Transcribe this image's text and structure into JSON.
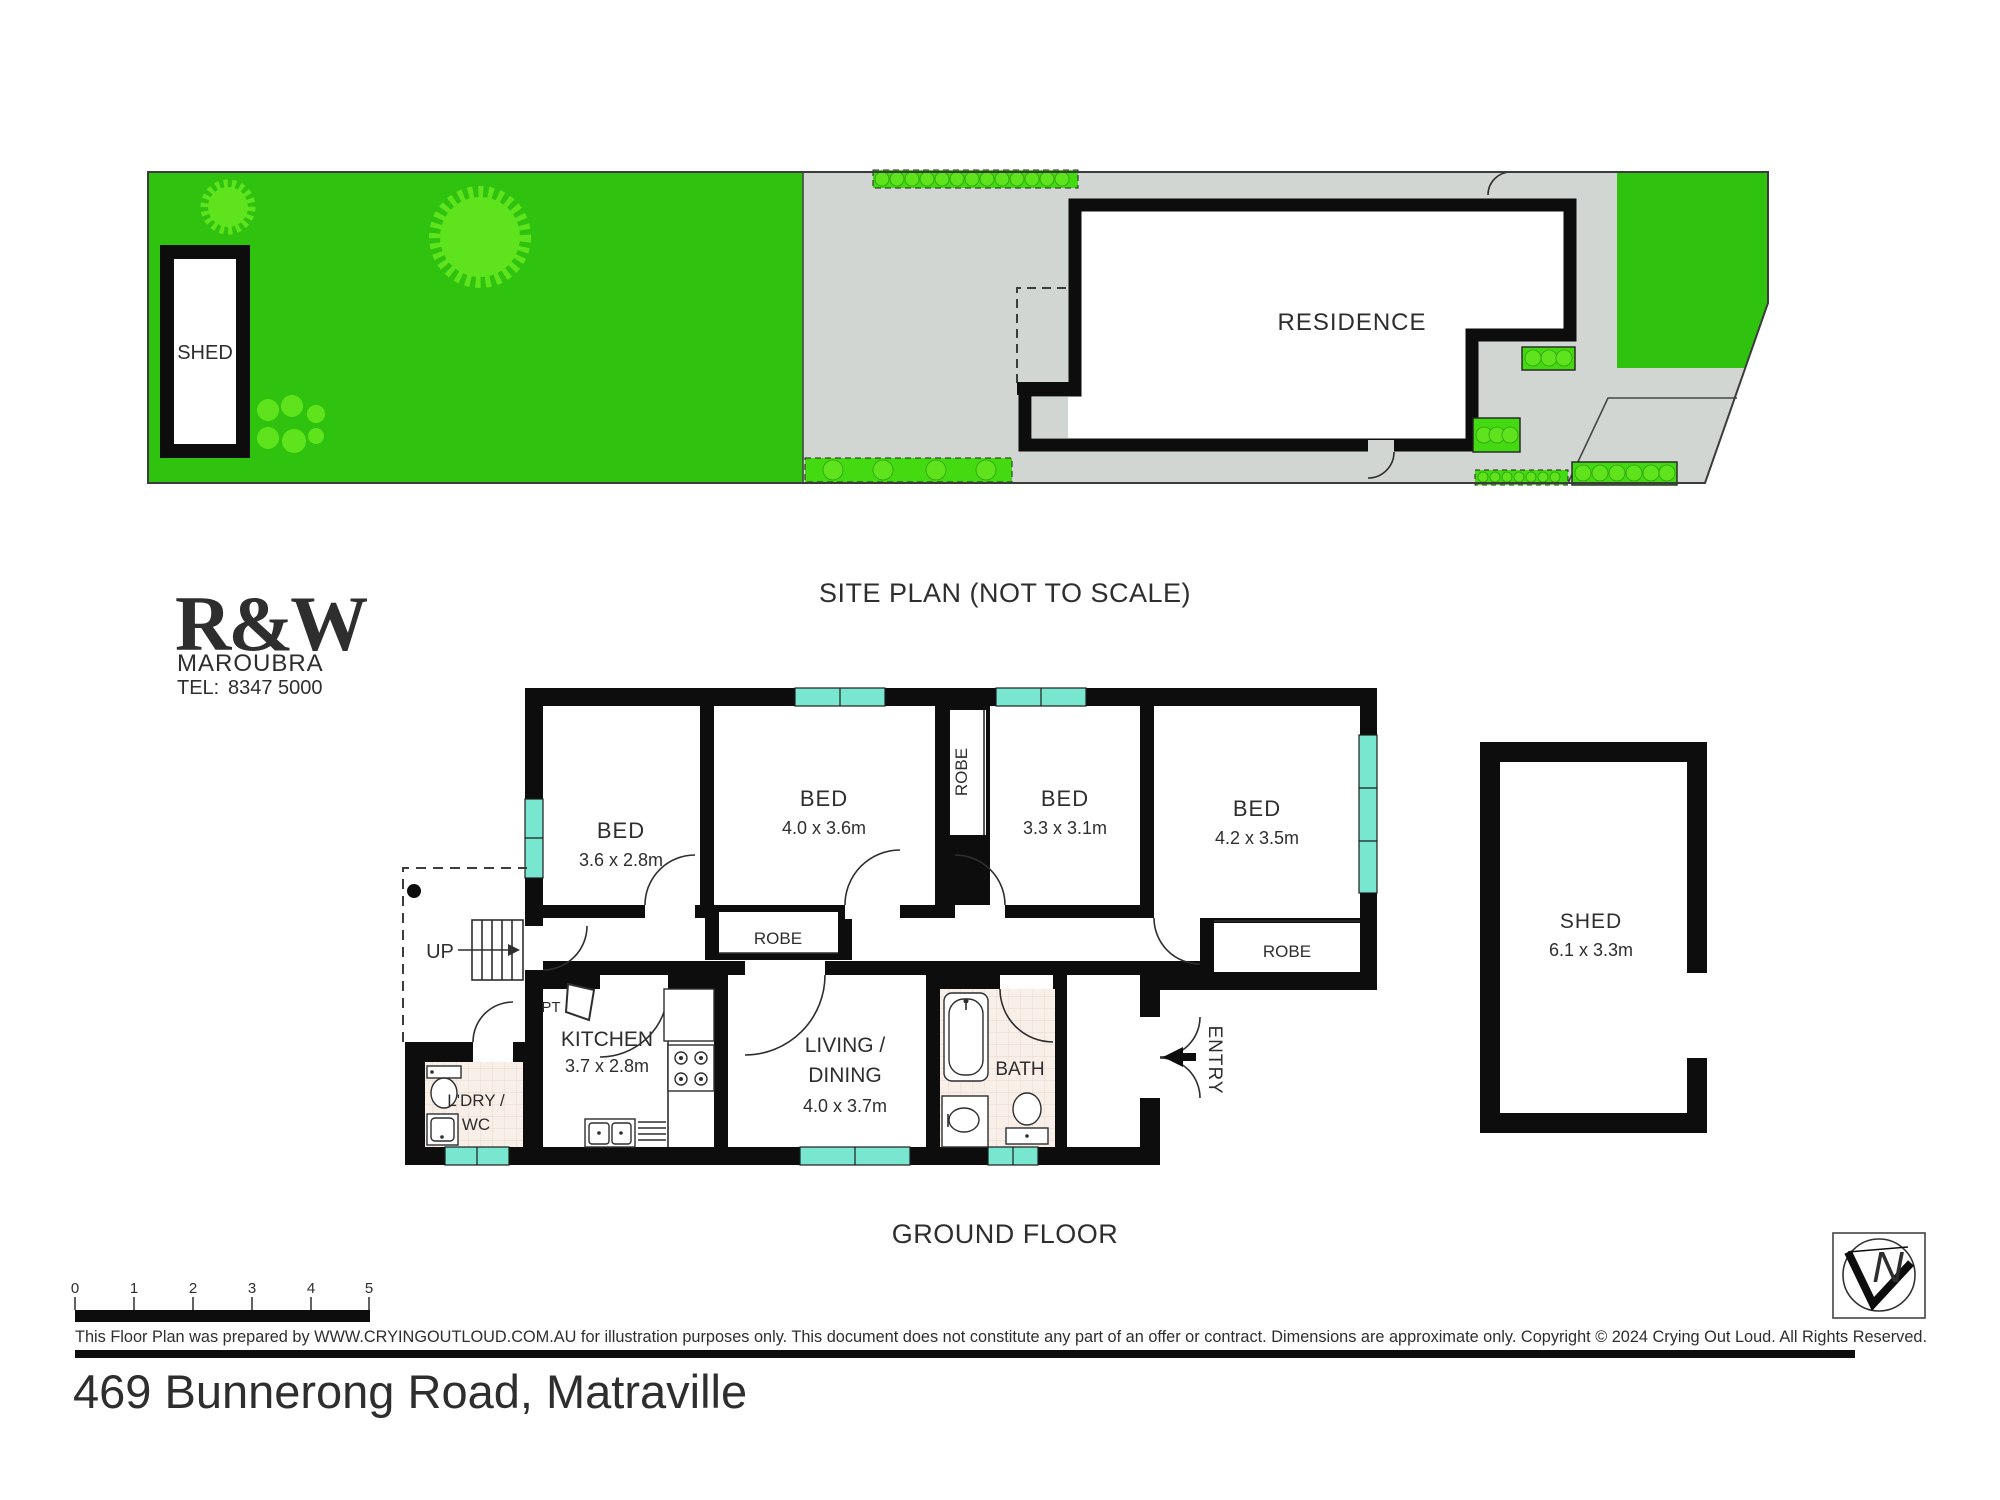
{
  "title": {
    "site_plan": "SITE PLAN (NOT TO SCALE)",
    "ground_floor": "GROUND FLOOR",
    "address": "469 Bunnerong Road, Matraville"
  },
  "logo": {
    "brand": "R&W",
    "suburb": "MAROUBRA",
    "tel_label": "TEL:",
    "tel_number": "8347 5000"
  },
  "site": {
    "residence_label": "RESIDENCE",
    "shed_label": "SHED"
  },
  "rooms": {
    "bed1": {
      "name": "BED",
      "dims": "3.6 x 2.8m"
    },
    "bed2": {
      "name": "BED",
      "dims": "4.0 x 3.6m"
    },
    "bed3": {
      "name": "BED",
      "dims": "3.3 x 3.1m"
    },
    "bed4": {
      "name": "BED",
      "dims": "4.2 x 3.5m"
    },
    "kitchen": {
      "name": "KITCHEN",
      "dims": "3.7 x 2.8m"
    },
    "living": {
      "name_line1": "LIVING /",
      "name_line2": "DINING",
      "dims": "4.0 x 3.7m"
    },
    "bath": {
      "name": "BATH"
    },
    "laundry": {
      "name_line1": "L'DRY /",
      "name_line2": "WC"
    },
    "shed": {
      "name": "SHED",
      "dims": "6.1 x 3.3m"
    },
    "robe": "ROBE",
    "pt": "PT",
    "up": "UP",
    "entry": "ENTRY"
  },
  "scalebar": {
    "ticks": [
      "0",
      "1",
      "2",
      "3",
      "4",
      "5"
    ]
  },
  "footer": {
    "disclaimer": "This Floor Plan was prepared by WWW.CRYINGOUTLOUD.COM.AU for illustration purposes only. This document does not constitute any part of an offer or contract. Dimensions are approximate only. Copyright © 2024 Crying Out Loud. All Rights Reserved.",
    "north": "N"
  },
  "colors": {
    "lawn": "#2fc30f",
    "garden_strip": "#44da12",
    "tree": "#5fe31c",
    "paving": "#d2d6d2",
    "window": "#79e7cf",
    "tile": "#f8efe9",
    "wall": "#0d0d0d",
    "brand_red": "#e4202c"
  }
}
